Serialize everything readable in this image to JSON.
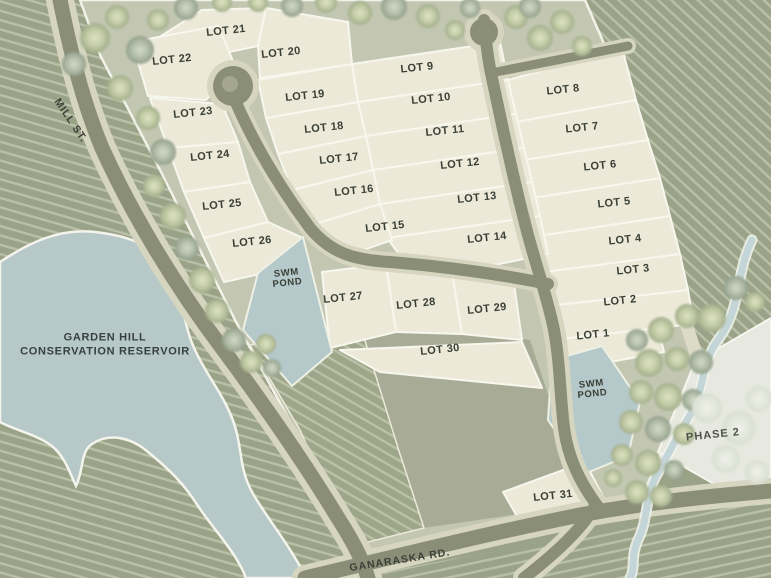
{
  "lots": [
    {
      "label": "LOT 1"
    },
    {
      "label": "LOT 2"
    },
    {
      "label": "LOT 3"
    },
    {
      "label": "LOT 4"
    },
    {
      "label": "LOT 5"
    },
    {
      "label": "LOT 6"
    },
    {
      "label": "LOT 7"
    },
    {
      "label": "LOT 8"
    },
    {
      "label": "LOT 9"
    },
    {
      "label": "LOT 10"
    },
    {
      "label": "LOT 11"
    },
    {
      "label": "LOT 12"
    },
    {
      "label": "LOT 13"
    },
    {
      "label": "LOT 14"
    },
    {
      "label": "LOT 15"
    },
    {
      "label": "LOT 16"
    },
    {
      "label": "LOT 17"
    },
    {
      "label": "LOT 18"
    },
    {
      "label": "LOT 19"
    },
    {
      "label": "LOT 20"
    },
    {
      "label": "LOT 21"
    },
    {
      "label": "LOT 22"
    },
    {
      "label": "LOT 23"
    },
    {
      "label": "LOT 24"
    },
    {
      "label": "LOT 25"
    },
    {
      "label": "LOT 26"
    },
    {
      "label": "LOT 27"
    },
    {
      "label": "LOT 28"
    },
    {
      "label": "LOT 29"
    },
    {
      "label": "LOT 30"
    },
    {
      "label": "LOT 31"
    }
  ],
  "streets": {
    "mill": "MILL ST.",
    "ganaraska": "GANARASKA RD."
  },
  "water": {
    "reservoir_line1": "GARDEN HILL",
    "reservoir_line2": "CONSERVATION RESERVOIR"
  },
  "ponds": [
    {
      "line1": "SWM",
      "line2": "POND"
    },
    {
      "line1": "SWM",
      "line2": "POND"
    }
  ],
  "areas": {
    "phase2": "PHASE 2"
  },
  "colors": {
    "lot_fill": "#ece9d8",
    "road": "#8b8e77",
    "road_shoulder": "#d6d5c0",
    "water": "#b7c8c9",
    "field_base": "#9aa287",
    "field_stripe": "#b9c0a7",
    "tree_area": "#c3c7b2",
    "label_text": "#3a3f36"
  }
}
